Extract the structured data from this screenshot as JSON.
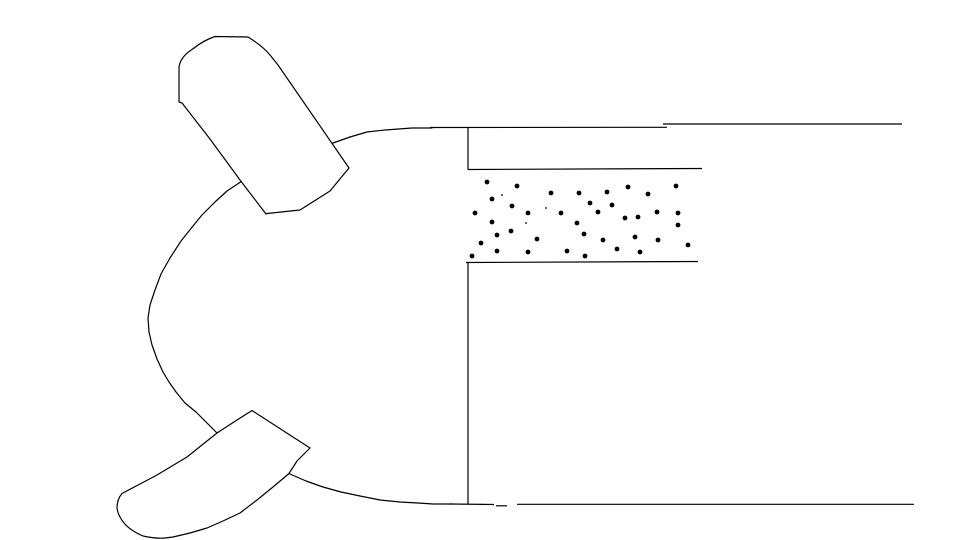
{
  "canvas": {
    "width": 960,
    "height": 540,
    "paper_color": "#ffffff",
    "ink_color": "#000000",
    "stroke_width": 1.2
  },
  "figure": {
    "body_outline": {
      "points": [
        [
          432,
          128
        ],
        [
          412,
          128
        ],
        [
          385,
          130
        ],
        [
          367,
          132
        ],
        [
          350,
          137
        ],
        [
          333,
          143
        ],
        [
          310,
          152
        ],
        [
          288,
          162
        ],
        [
          265,
          171
        ],
        [
          242,
          181
        ],
        [
          227,
          191
        ],
        [
          215,
          202
        ],
        [
          202,
          215
        ],
        [
          193,
          226
        ],
        [
          181,
          241
        ],
        [
          170,
          258
        ],
        [
          161,
          274
        ],
        [
          155,
          290
        ],
        [
          150,
          305
        ],
        [
          148,
          318
        ],
        [
          149,
          332
        ],
        [
          152,
          345
        ],
        [
          157,
          359
        ],
        [
          163,
          372
        ],
        [
          169,
          382
        ],
        [
          176,
          392
        ],
        [
          185,
          403
        ],
        [
          196,
          412
        ],
        [
          216,
          432
        ],
        [
          232,
          444
        ],
        [
          250,
          455
        ],
        [
          270,
          466
        ],
        [
          290,
          474
        ],
        [
          306,
          481
        ],
        [
          323,
          487
        ],
        [
          341,
          492
        ],
        [
          360,
          496
        ],
        [
          380,
          500
        ],
        [
          400,
          502
        ],
        [
          418,
          503
        ],
        [
          433,
          504
        ],
        [
          452,
          504
        ]
      ]
    },
    "lines": [
      {
        "name": "top-wall-line-left",
        "x1": 430,
        "y1": 127.5,
        "x2": 667,
        "y2": 127.3
      },
      {
        "name": "top-wall-line-right",
        "x1": 663,
        "y1": 124,
        "x2": 902,
        "y2": 124
      },
      {
        "name": "face-vertical-line-upper",
        "x1": 468,
        "y1": 128,
        "x2": 468,
        "y2": 169.5
      },
      {
        "name": "stipple-band-top-line",
        "x1": 468,
        "y1": 169.5,
        "x2": 702,
        "y2": 168.5
      },
      {
        "name": "stipple-band-bottom-line",
        "x1": 466,
        "y1": 262.5,
        "x2": 698,
        "y2": 261.5
      },
      {
        "name": "face-vertical-line-lower",
        "x1": 468,
        "y1": 262.5,
        "x2": 468,
        "y2": 504
      },
      {
        "name": "bottom-wall-line-left",
        "x1": 450,
        "y1": 504,
        "x2": 494,
        "y2": 504.5
      },
      {
        "name": "bottom-wall-line-dash",
        "x1": 496,
        "y1": 505.8,
        "x2": 507,
        "y2": 505.8
      },
      {
        "name": "bottom-wall-line-right",
        "x1": 517,
        "y1": 504.3,
        "x2": 914,
        "y2": 504.3
      }
    ],
    "paddles": [
      {
        "name": "upper-paddle",
        "path": "M 179 102 L 179 67 C 180 60 185 54 192 49.5 C 199 44 207 39 215 36.5 L 248 37 C 256 42 264 47.5 270 55 L 278 65 L 349 168 L 330 191 L 300 210 L 267 213.5 L 266 214 L 240 180 L 210 139 L 182 103 Z"
      },
      {
        "name": "lower-paddle",
        "path": "M 252 410.5 L 310 448 L 297 461 L 289 473.5 L 273 487 L 257 500 L 240 513 L 223 521 L 207 528 L 190 533 L 173 537 L 165 538 C 157 538.8 150 537.5 143 536 C 136 533 129 529 124 523 C 120 518 117.5 513 117 508 C 117 502 119 497 122 493.5 L 140 484 L 157 475 L 187 457 L 217 433 L 237 420 Z"
      }
    ],
    "stipple": {
      "dot_radius": 2.4,
      "dots": [
        [
          487,
          182
        ],
        [
          517,
          186
        ],
        [
          551,
          193
        ],
        [
          579,
          193
        ],
        [
          607,
          192
        ],
        [
          628,
          187
        ],
        [
          648,
          194
        ],
        [
          676,
          186
        ],
        [
          492,
          199
        ],
        [
          512,
          206
        ],
        [
          590,
          203
        ],
        [
          612,
          205
        ],
        [
          598,
          212
        ],
        [
          561,
          213
        ],
        [
          528,
          213
        ],
        [
          475,
          213
        ],
        [
          625,
          218
        ],
        [
          638,
          217
        ],
        [
          657,
          212
        ],
        [
          678,
          213
        ],
        [
          492,
          222
        ],
        [
          577,
          223
        ],
        [
          678,
          225
        ],
        [
          511,
          231
        ],
        [
          497,
          235
        ],
        [
          584,
          234
        ],
        [
          537,
          239
        ],
        [
          603,
          240
        ],
        [
          635,
          237
        ],
        [
          658,
          240
        ],
        [
          481,
          243
        ],
        [
          617,
          249
        ],
        [
          688,
          245
        ],
        [
          497,
          251
        ],
        [
          528,
          252
        ],
        [
          567,
          251
        ],
        [
          640,
          252
        ],
        [
          585,
          256
        ],
        [
          472,
          256
        ]
      ],
      "speck_radius": 0.9,
      "specks": [
        [
          502,
          195
        ],
        [
          546,
          208
        ],
        [
          526,
          223
        ]
      ]
    }
  }
}
